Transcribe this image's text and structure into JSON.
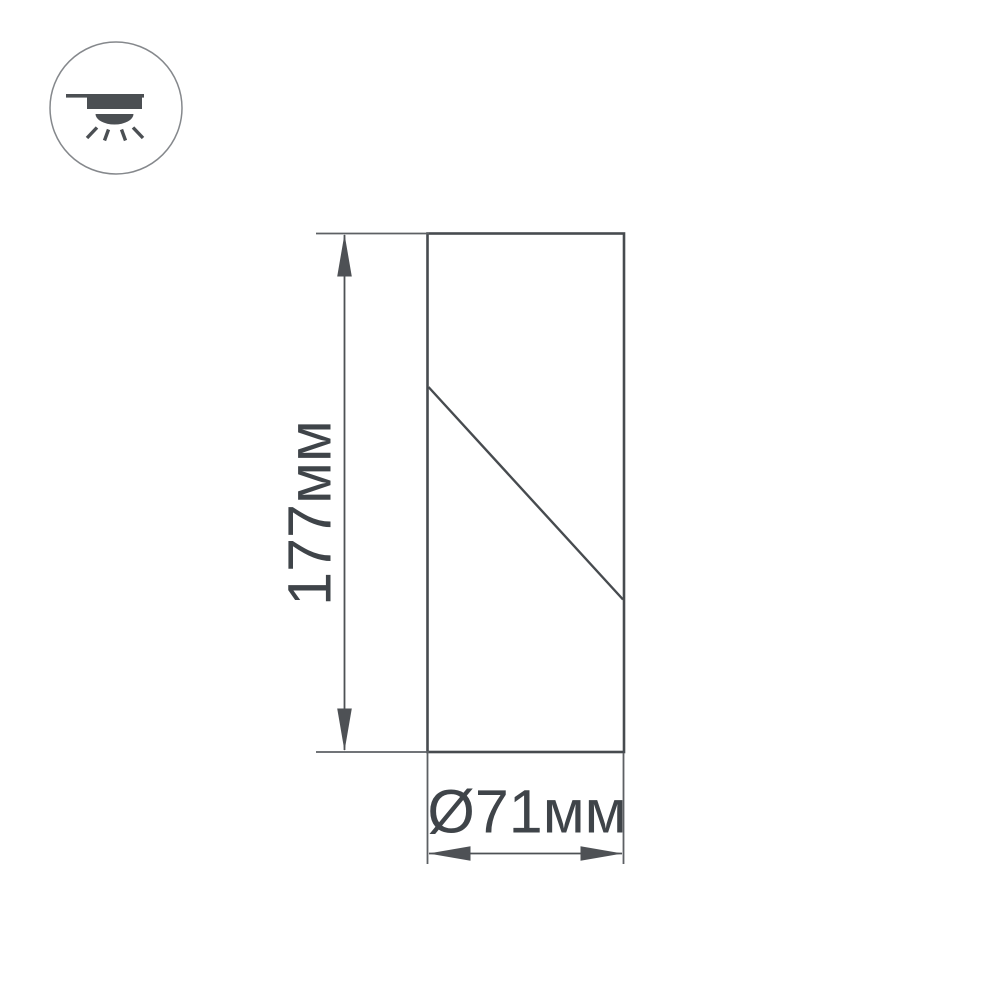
{
  "colors": {
    "background": "#ffffff",
    "outline": "#474b4f",
    "dimension": "#4e5155",
    "extension": "#5d6064",
    "icon-glyph": "#4b4f53",
    "icon-outline": "#85888c",
    "text": "#3f4449"
  },
  "icon": {
    "name": "surface-mounted-ceiling-downlight"
  },
  "drawing": {
    "type": "product-dimension-diagram",
    "height_label": "177мм",
    "diameter_label": "Ø71мм",
    "height_mm": 177,
    "diameter_mm": 71,
    "unit": "мм"
  }
}
